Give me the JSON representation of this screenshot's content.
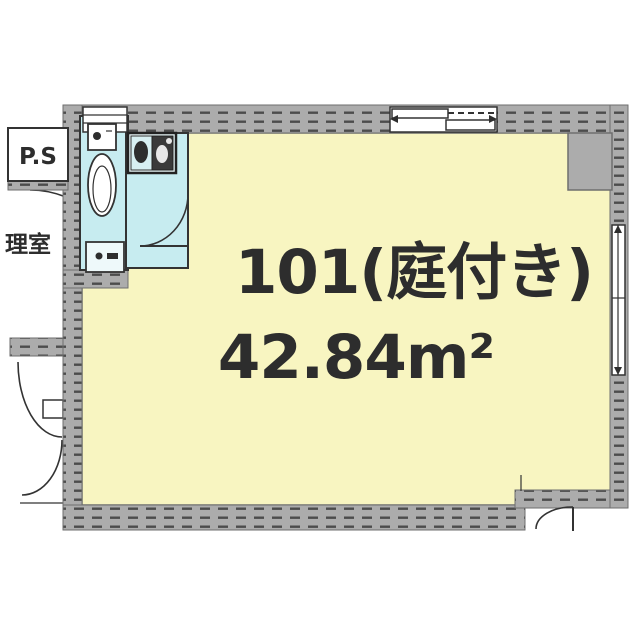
{
  "floor_plan": {
    "unit_label": "101(庭付き)",
    "area_label": "42.84m²",
    "pipe_space_label": "P.S",
    "corridor_label": "理室"
  },
  "colors": {
    "room-fill": "#f8f5c1",
    "wet-area-fill": "#c7ecf0",
    "wall-fill": "#acacac",
    "wall-edge": "#6e6e6e",
    "hatch-dash": "#4c4c4c",
    "line": "#333333",
    "text": "#2d2d2d"
  }
}
